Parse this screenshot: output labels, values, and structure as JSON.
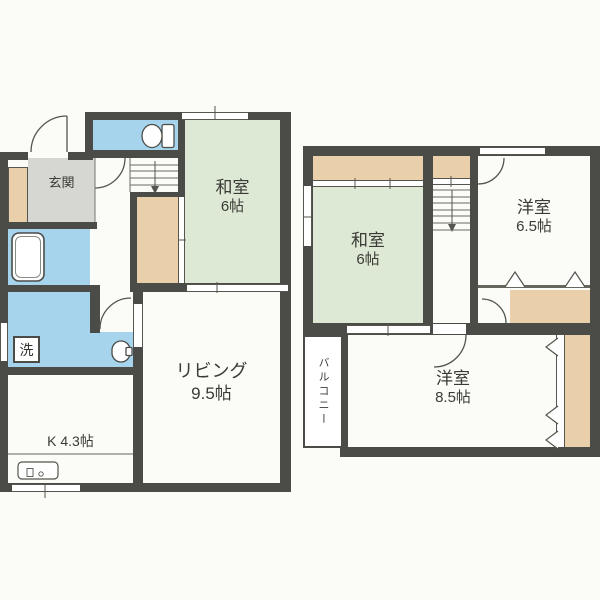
{
  "plan_title": "2-story house floor plan",
  "rooms": {
    "genkan": {
      "label": "玄関"
    },
    "washitsu_1f": {
      "name": "和室",
      "size": "6帖"
    },
    "living": {
      "name": "リビング",
      "size": "9.5帖"
    },
    "kitchen": {
      "label": "K 4.3帖"
    },
    "laundry": {
      "label": "洗"
    },
    "washitsu_2f": {
      "name": "和室",
      "size": "6帖"
    },
    "yoshitsu_65": {
      "name": "洋室",
      "size": "6.5帖"
    },
    "yoshitsu_85": {
      "name": "洋室",
      "size": "8.5帖"
    },
    "balcony": {
      "label": "バルコニー"
    }
  },
  "icons": [
    "toilet-icon",
    "washbasin-toilet-icon",
    "bathtub-icon",
    "kitchen-sink-icon",
    "stairs-down-arrow-icon",
    "door-swing-arc",
    "sliding-door-marks",
    "folding-door-chevrons"
  ],
  "colors": {
    "wall": "#4b4b48",
    "water_rooms_blue": "#a6d4ec",
    "tatami_green": "#dde9d4",
    "closet_beige": "#e9cfaa",
    "entrance_gray": "#d6d6d2",
    "paper": "#fbfbf7"
  }
}
